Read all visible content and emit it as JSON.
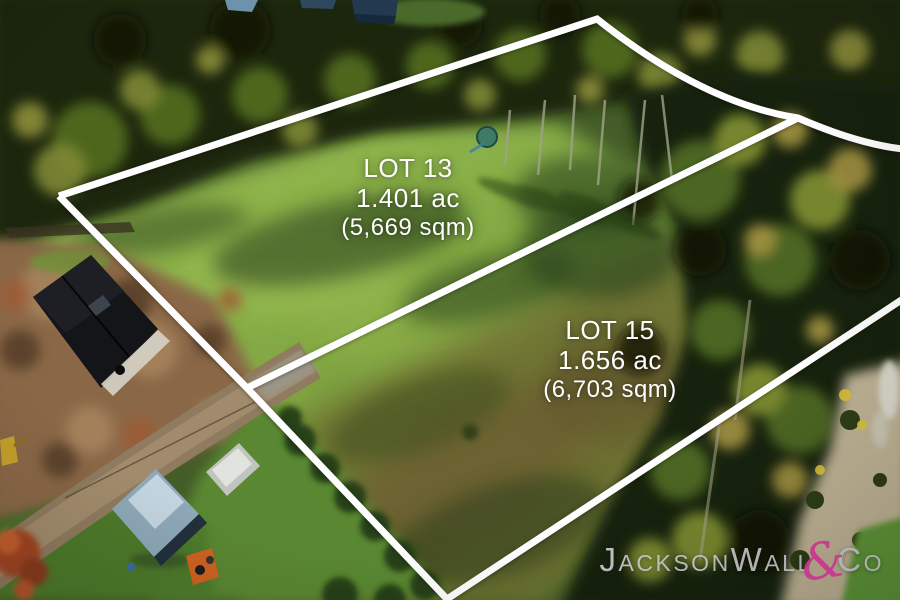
{
  "overlay": {
    "boundary_color": "#ffffff",
    "lots": [
      {
        "name": "LOT 13",
        "area_acres": "1.401 ac",
        "area_sqm": "(5,669 sqm)"
      },
      {
        "name": "LOT 15",
        "area_acres": "1.656 ac",
        "area_sqm": "(6,703 sqm)"
      }
    ]
  },
  "branding": {
    "name": "JacksonWall",
    "ampersand": "&",
    "suffix": "Co",
    "text_color": "#d1d2d6",
    "accent_color": "#c73a8f"
  }
}
